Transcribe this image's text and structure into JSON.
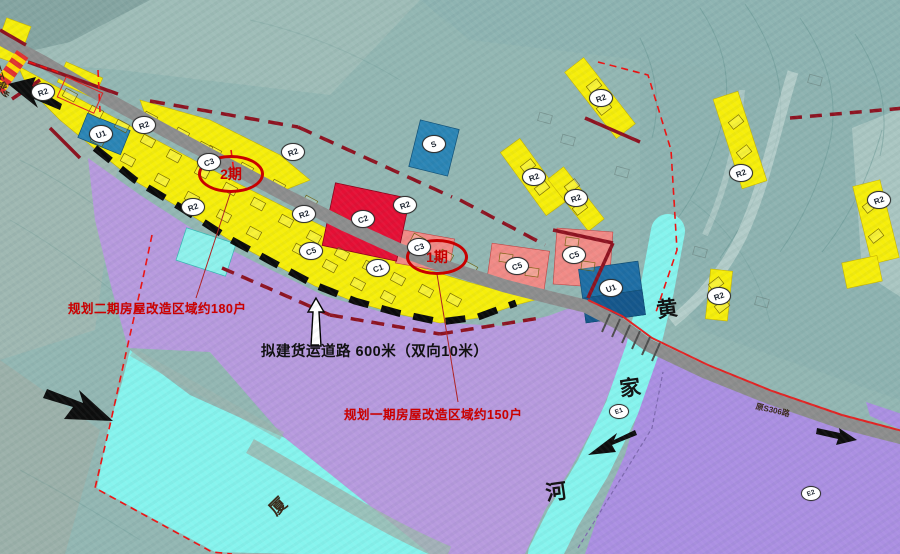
{
  "map": {
    "phase_markers": [
      {
        "id": "phase2",
        "label": "2期",
        "x": 231,
        "y": 174,
        "w": 60,
        "h": 32
      },
      {
        "id": "phase1",
        "label": "1期",
        "x": 437,
        "y": 257,
        "w": 56,
        "h": 30
      }
    ],
    "annotations": [
      {
        "id": "phase2_note",
        "text": "规划二期房屋改造区域约180户",
        "color": "#cc0000",
        "x": 68,
        "y": 298
      },
      {
        "id": "road_note",
        "text": "拟建货运道路 600米（双向10米）",
        "color": "#111111",
        "x": 261,
        "y": 340
      },
      {
        "id": "phase1_note",
        "text": "规划一期房屋改造区域约150户",
        "color": "#cc0000",
        "x": 344,
        "y": 404
      }
    ],
    "river": {
      "name": "黄家河",
      "chars": [
        {
          "ch": "黄",
          "x": 667,
          "y": 308
        },
        {
          "ch": "家",
          "x": 630,
          "y": 387
        },
        {
          "ch": "河",
          "x": 556,
          "y": 491
        }
      ]
    },
    "edge_labels": [
      {
        "id": "left_exit_road",
        "text": "至玉泉乡",
        "x": 2,
        "y": 62,
        "rotate": 72,
        "size": 9
      },
      {
        "id": "old_road_name",
        "text": "原S306路",
        "x": 757,
        "y": 401,
        "rotate": 13,
        "size": 8
      },
      {
        "id": "riverside_area_char",
        "text": "厦",
        "x": 262,
        "y": 502,
        "rotate": -44,
        "size": 17
      }
    ],
    "zone_bubbles": [
      {
        "code": "R2",
        "x": 42,
        "y": 91
      },
      {
        "code": "U1",
        "x": 100,
        "y": 133
      },
      {
        "code": "R2",
        "x": 143,
        "y": 124
      },
      {
        "code": "C3",
        "x": 208,
        "y": 161
      },
      {
        "code": "R2",
        "x": 192,
        "y": 206
      },
      {
        "code": "R2",
        "x": 292,
        "y": 151
      },
      {
        "code": "R2",
        "x": 303,
        "y": 213
      },
      {
        "code": "C2",
        "x": 362,
        "y": 218
      },
      {
        "code": "R2",
        "x": 404,
        "y": 204
      },
      {
        "code": "C5",
        "x": 310,
        "y": 250
      },
      {
        "code": "C1",
        "x": 377,
        "y": 267
      },
      {
        "code": "C3",
        "x": 418,
        "y": 246
      },
      {
        "code": "S",
        "x": 433,
        "y": 143
      },
      {
        "code": "R2",
        "x": 533,
        "y": 176
      },
      {
        "code": "R2",
        "x": 575,
        "y": 197
      },
      {
        "code": "R2",
        "x": 600,
        "y": 97
      },
      {
        "code": "C5",
        "x": 516,
        "y": 265
      },
      {
        "code": "C5",
        "x": 573,
        "y": 254
      },
      {
        "code": "U1",
        "x": 610,
        "y": 287
      },
      {
        "code": "R2",
        "x": 718,
        "y": 295
      },
      {
        "code": "R2",
        "x": 740,
        "y": 172
      },
      {
        "code": "R2",
        "x": 878,
        "y": 199
      },
      {
        "code": "E1",
        "x": 618,
        "y": 412
      },
      {
        "code": "E2",
        "x": 810,
        "y": 494
      }
    ],
    "colors": {
      "residential_yellow": "#f6ee0a",
      "commercial_red": "#e50f35",
      "commercial_salmon": "#f18a86",
      "utility_blue": "#2b85b5",
      "road_gray": "#8d8d8d",
      "river_cyan": "#86f4ee",
      "phase_area_purple": "#b79ade",
      "field_purple": "#ab8fe2",
      "boundary_red": "#ee1111",
      "boundary_dark_red": "#8e1220",
      "terrain_teal": "#93b7b3"
    }
  }
}
